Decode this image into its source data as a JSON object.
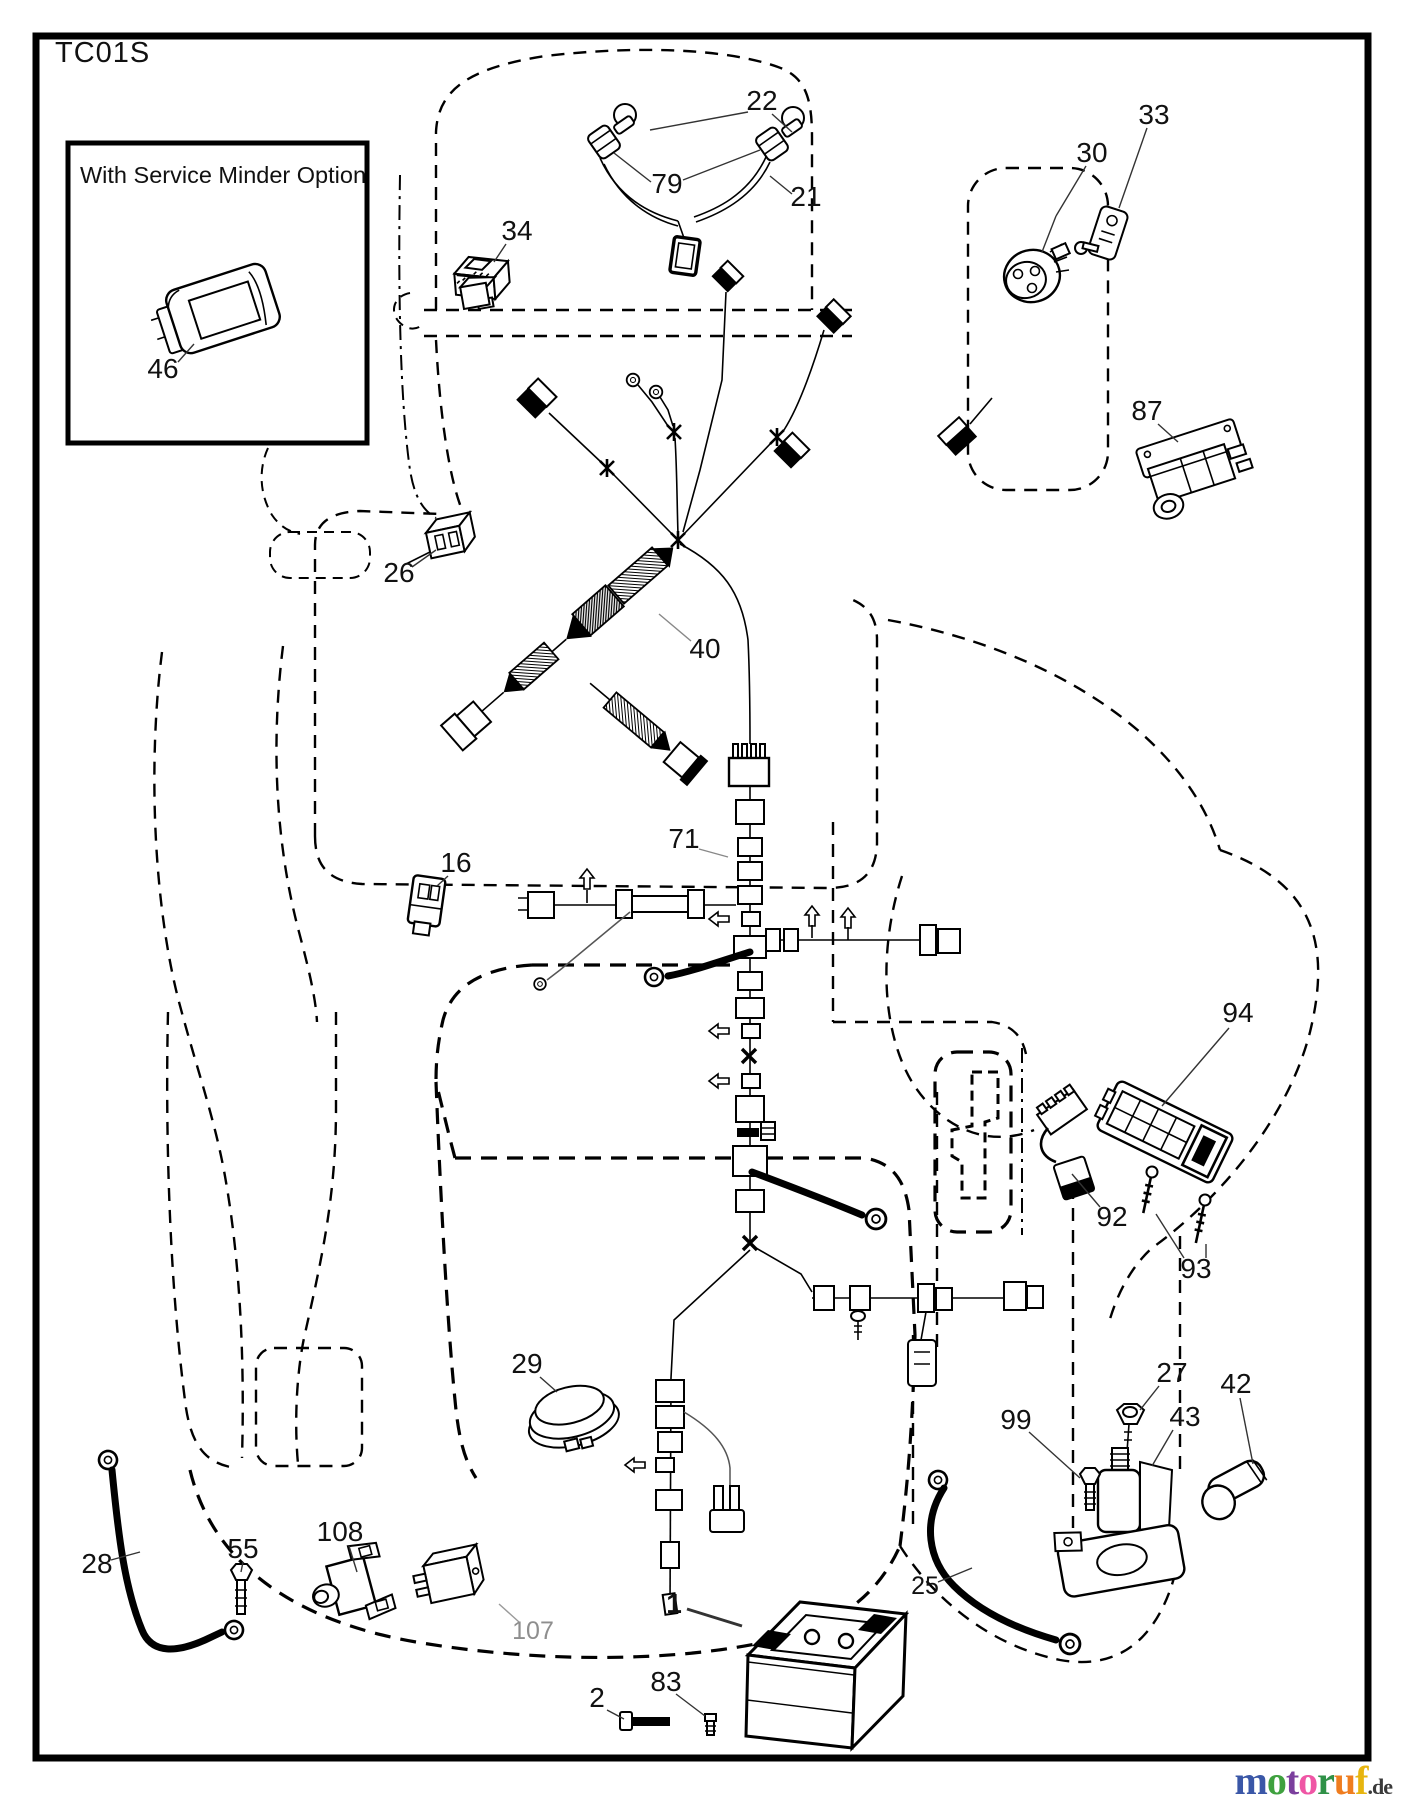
{
  "page": {
    "title": "TC01S",
    "inset_label": "With Service Minder Option",
    "watermark": {
      "letters": [
        {
          "ch": "m",
          "color": "#3a57a7"
        },
        {
          "ch": "o",
          "color": "#3fa13f"
        },
        {
          "ch": "t",
          "color": "#7b3f9d"
        },
        {
          "ch": "o",
          "color": "#ef56a5"
        },
        {
          "ch": "r",
          "color": "#2f9147"
        },
        {
          "ch": "u",
          "color": "#ef7d1f"
        },
        {
          "ch": "f",
          "color": "#e7b50f"
        }
      ],
      "suffix": ".de",
      "suffix_color": "#3a3a3a"
    }
  },
  "diagram": {
    "part_labels": [
      {
        "text": "22",
        "x": 762,
        "y": 110,
        "leaders": [
          [
            748,
            112,
            650,
            130
          ],
          [
            772,
            114,
            792,
            132
          ]
        ]
      },
      {
        "text": "79",
        "x": 667,
        "y": 193,
        "leaders": [
          [
            651,
            182,
            614,
            153
          ],
          [
            683,
            180,
            760,
            150
          ]
        ]
      },
      {
        "text": "21",
        "x": 806,
        "y": 206,
        "leaders": [
          [
            792,
            194,
            770,
            176
          ]
        ]
      },
      {
        "text": "34",
        "x": 517,
        "y": 240,
        "leaders": [
          [
            506,
            244,
            494,
            262
          ]
        ]
      },
      {
        "text": "30",
        "x": 1092,
        "y": 162,
        "leaders": [
          [
            1086,
            166,
            1056,
            216
          ],
          [
            1056,
            216,
            1042,
            252
          ]
        ]
      },
      {
        "text": "33",
        "x": 1154,
        "y": 124,
        "leaders": [
          [
            1147,
            128,
            1119,
            208
          ]
        ]
      },
      {
        "text": "87",
        "x": 1147,
        "y": 420,
        "leaders": [
          [
            1158,
            424,
            1178,
            442
          ]
        ]
      },
      {
        "text": "26",
        "x": 399,
        "y": 582,
        "leaders": [
          [
            412,
            567,
            436,
            550
          ]
        ]
      },
      {
        "text": "40",
        "x": 705,
        "y": 658,
        "leader_color": "#888",
        "leaders": [
          [
            691,
            641,
            659,
            614
          ]
        ]
      },
      {
        "text": "16",
        "x": 456,
        "y": 872,
        "leaders": [
          [
            448,
            876,
            437,
            886
          ]
        ]
      },
      {
        "text": "71",
        "x": 684,
        "y": 848,
        "leader_color": "#888",
        "leaders": [
          [
            699,
            849,
            728,
            857
          ]
        ]
      },
      {
        "text": "94",
        "x": 1238,
        "y": 1022,
        "leaders": [
          [
            1229,
            1028,
            1162,
            1106
          ]
        ]
      },
      {
        "text": "92",
        "x": 1112,
        "y": 1226,
        "leaders": [
          [
            1100,
            1207,
            1072,
            1174
          ]
        ]
      },
      {
        "text": "93",
        "x": 1196,
        "y": 1278,
        "leaders": [
          [
            1184,
            1258,
            1156,
            1214
          ],
          [
            1206,
            1258,
            1206,
            1244
          ]
        ]
      },
      {
        "text": "27",
        "x": 1172,
        "y": 1382,
        "leaders": [
          [
            1159,
            1386,
            1140,
            1410
          ]
        ]
      },
      {
        "text": "42",
        "x": 1236,
        "y": 1393,
        "leaders": [
          [
            1240,
            1398,
            1253,
            1464
          ]
        ]
      },
      {
        "text": "43",
        "x": 1185,
        "y": 1426,
        "leaders": [
          [
            1173,
            1430,
            1152,
            1466
          ]
        ]
      },
      {
        "text": "99",
        "x": 1016,
        "y": 1429,
        "leaders": [
          [
            1029,
            1432,
            1080,
            1478
          ]
        ]
      },
      {
        "text": "25",
        "x": 925,
        "y": 1594,
        "size": 25,
        "leaders": [
          [
            938,
            1582,
            972,
            1568
          ]
        ]
      },
      {
        "text": "28",
        "x": 97,
        "y": 1573,
        "leaders": [
          [
            111,
            1560,
            140,
            1552
          ]
        ]
      },
      {
        "text": "55",
        "x": 243,
        "y": 1558,
        "leaders": [
          [
            243,
            1562,
            241,
            1572
          ]
        ]
      },
      {
        "text": "108",
        "x": 340,
        "y": 1541,
        "leaders": [
          [
            349,
            1546,
            357,
            1572
          ]
        ]
      },
      {
        "text": "107",
        "x": 533,
        "y": 1639,
        "size": 25,
        "color": "#8e8e8e",
        "leader_color": "#9a9a9a",
        "leaders": [
          [
            519,
            1622,
            499,
            1604
          ]
        ]
      },
      {
        "text": "1",
        "x": 674,
        "y": 1613,
        "bold": true,
        "leader_width": 3,
        "leaders": [
          [
            687,
            1609,
            742,
            1626
          ]
        ]
      },
      {
        "text": "2",
        "x": 597,
        "y": 1707,
        "leaders": [
          [
            607,
            1710,
            624,
            1719
          ]
        ]
      },
      {
        "text": "83",
        "x": 666,
        "y": 1691,
        "leaders": [
          [
            676,
            1694,
            705,
            1716
          ]
        ]
      },
      {
        "text": "29",
        "x": 527,
        "y": 1373,
        "leaders": [
          [
            540,
            1377,
            557,
            1392
          ]
        ]
      },
      {
        "text": "46",
        "x": 163,
        "y": 378,
        "leaders": [
          [
            178,
            362,
            194,
            344
          ]
        ]
      }
    ]
  }
}
